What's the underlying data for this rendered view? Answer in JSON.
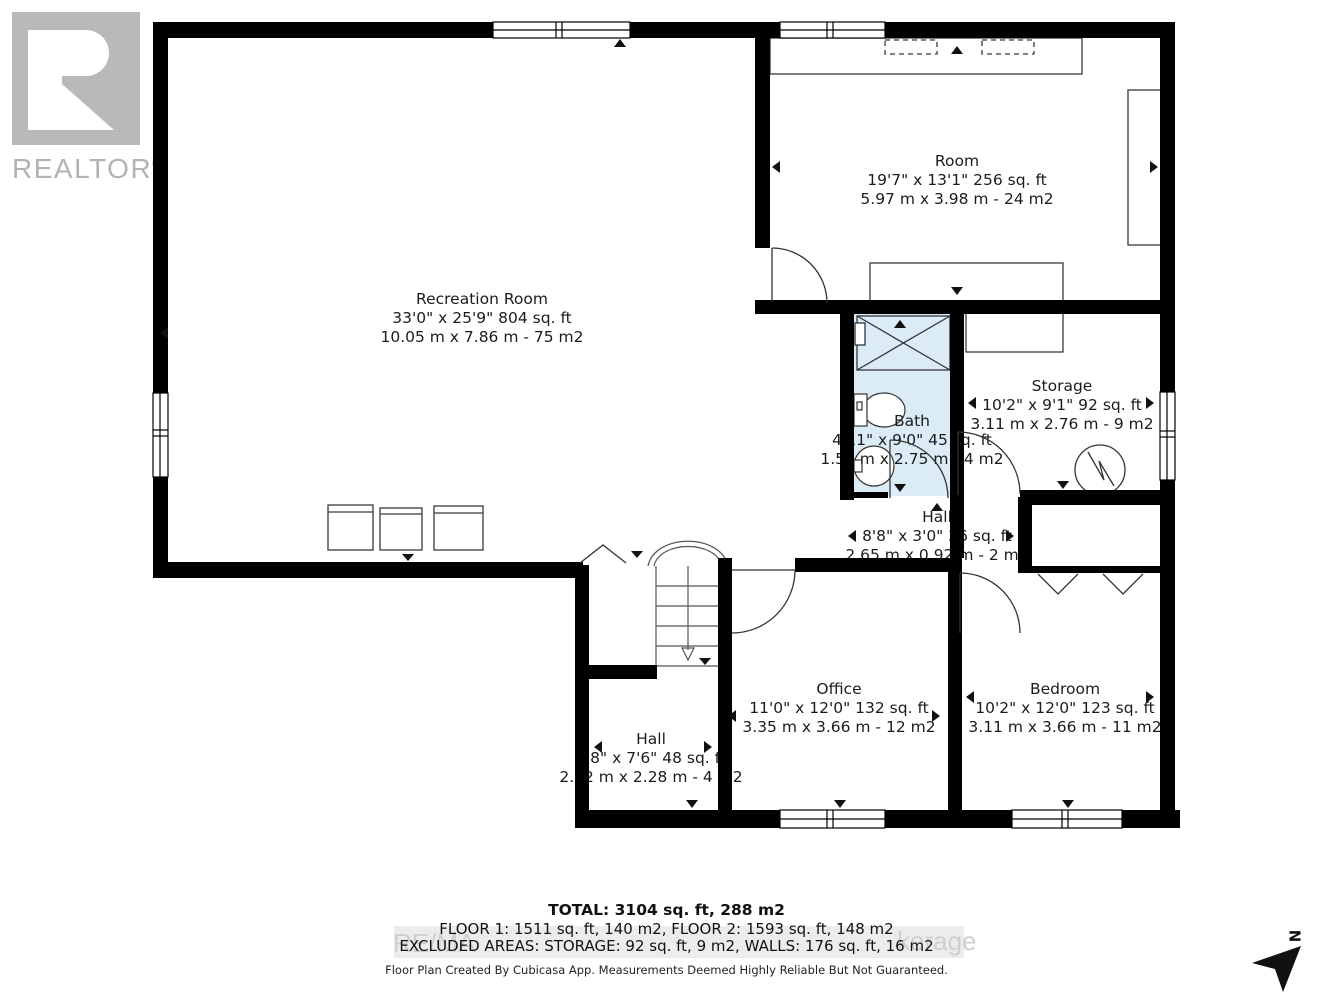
{
  "branding": {
    "realtor_text": "REALTOR",
    "registered_mark": "®"
  },
  "rooms": [
    {
      "id": "recreation",
      "name": "Recreation Room",
      "dims_imperial": "33'0\" x 25'9\" 804 sq. ft",
      "dims_metric": "10.05 m x 7.86 m - 75 m2"
    },
    {
      "id": "room",
      "name": "Room",
      "dims_imperial": "19'7\" x 13'1\" 256 sq. ft",
      "dims_metric": "5.97 m x 3.98 m - 24 m2"
    },
    {
      "id": "bath",
      "name": "Bath",
      "dims_imperial": "4'11\" x 9'0\" 45 sq. ft",
      "dims_metric": "1.50 m x 2.75 m - 4 m2"
    },
    {
      "id": "storage",
      "name": "Storage",
      "dims_imperial": "10'2\" x 9'1\" 92 sq. ft",
      "dims_metric": "3.11 m x 2.76 m - 9 m2"
    },
    {
      "id": "hall-mid",
      "name": "Hall",
      "dims_imperial": "8'8\" x 3'0\" 26 sq. ft",
      "dims_metric": "2.65 m x 0.92 m - 2 m2"
    },
    {
      "id": "office",
      "name": "Office",
      "dims_imperial": "11'0\" x 12'0\" 132 sq. ft",
      "dims_metric": "3.35 m x 3.66 m - 12 m2"
    },
    {
      "id": "bedroom",
      "name": "Bedroom",
      "dims_imperial": "10'2\" x 12'0\" 123 sq. ft",
      "dims_metric": "3.11 m x 3.66 m - 11 m2"
    },
    {
      "id": "hall-lower",
      "name": "Hall",
      "dims_imperial": "6'8\" x 7'6\" 48 sq. ft",
      "dims_metric": "2.02 m x 2.28 m - 4 m2"
    }
  ],
  "summary": {
    "total": "TOTAL: 3104 sq. ft, 288 m2",
    "floors": "FLOOR 1: 1511 sq. ft, 140 m2, FLOOR 2: 1593 sq. ft, 148 m2",
    "excluded": "EXCLUDED AREAS: STORAGE: 92 sq. ft, 9 m2, WALLS: 176 sq. ft, 16 m2"
  },
  "footer": {
    "disclaimer": "Floor Plan Created By Cubicasa App. Measurements Deemed Highly Reliable But Not Guaranteed."
  },
  "watermark": {
    "left_fragment": "RE/MA",
    "right_fragment": "kerage"
  },
  "compass": {
    "north_label": "N"
  },
  "colors": {
    "wall": "#000000",
    "bath_fill": "#dbecf7",
    "logo_gray": "#b9b9b9",
    "watermark_gray": "#cfcfcf",
    "line": "#333333"
  }
}
